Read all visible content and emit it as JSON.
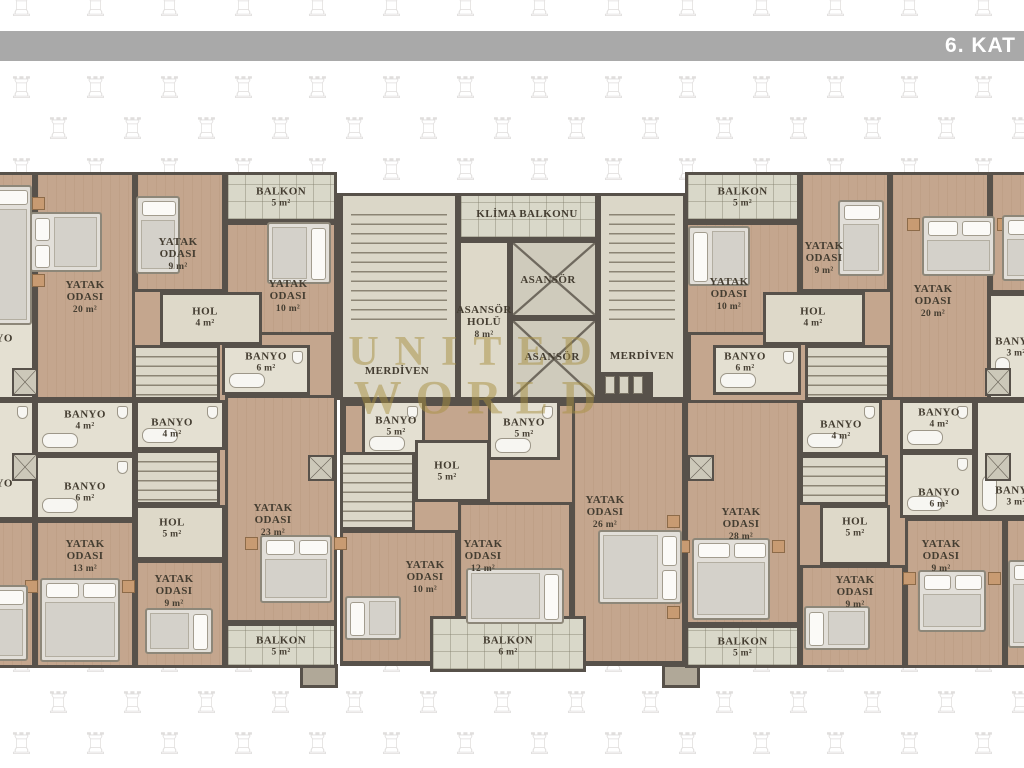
{
  "header": {
    "title": "6. KAT"
  },
  "watermark": {
    "line1": "UNITED",
    "line2": "WORLD"
  },
  "pattern": {
    "glyph": "♖",
    "x0": 8,
    "y0": -8,
    "dx": 74,
    "dy": 41,
    "stagger": 37,
    "cols": 15,
    "rows": 20,
    "size": 30
  },
  "floorplan": {
    "bases": [
      {
        "type": "bedroom",
        "x": -45,
        "y": 172,
        "w": 382,
        "h": 496
      },
      {
        "type": "core",
        "x": 337,
        "y": 193,
        "w": 350,
        "h": 207
      },
      {
        "type": "bedroom",
        "x": 340,
        "y": 400,
        "w": 345,
        "h": 266
      },
      {
        "type": "bedroom",
        "x": 685,
        "y": 172,
        "w": 385,
        "h": 496
      }
    ],
    "rooms": [
      {
        "id": "partial-bedroom-left-top",
        "type": "bedroom",
        "x": -45,
        "y": 172,
        "w": 80,
        "h": 121
      },
      {
        "id": "partial-bath-left-mid",
        "label": "BANYO",
        "area": "m²",
        "type": "bath",
        "x": -45,
        "y": 293,
        "w": 80,
        "h": 107,
        "lx": -8,
        "ly": 344
      },
      {
        "id": "partial-bath-left-bottom",
        "label": "BANYO",
        "area": "m²",
        "type": "bath",
        "x": -45,
        "y": 400,
        "w": 80,
        "h": 120,
        "lx": -8,
        "ly": 489
      },
      {
        "id": "partial-bedroom-left-bottom",
        "type": "bedroom",
        "x": -45,
        "y": 520,
        "w": 80,
        "h": 148
      },
      {
        "id": "yatak-odasi-20-left",
        "label": "YATAK ODASI",
        "area": "20 m²",
        "type": "bedroom",
        "x": 35,
        "y": 172,
        "w": 100,
        "h": 228,
        "lx": 85,
        "ly": 297
      },
      {
        "id": "yatak-odasi-9-left-top",
        "label": "YATAK ODASI",
        "area": "9 m²",
        "type": "bedroom",
        "x": 135,
        "y": 172,
        "w": 90,
        "h": 120,
        "lx": 178,
        "ly": 254
      },
      {
        "id": "balkon-5-left-top",
        "label": "BALKON",
        "area": "5 m²",
        "type": "balcony",
        "x": 225,
        "y": 172,
        "w": 112,
        "h": 50
      },
      {
        "id": "yatak-odasi-10-left-top",
        "label": "YATAK ODASI",
        "area": "10 m²",
        "type": "bedroom",
        "x": 225,
        "y": 222,
        "w": 112,
        "h": 113,
        "lx": 288,
        "ly": 296
      },
      {
        "id": "hol-4-left-top",
        "label": "HOL",
        "area": "4 m²",
        "type": "hall",
        "x": 160,
        "y": 292,
        "w": 102,
        "h": 53,
        "lx": 205,
        "ly": 317
      },
      {
        "id": "stairs-left-top",
        "type": "stair",
        "small": true,
        "x": 133,
        "y": 345,
        "w": 87,
        "h": 55
      },
      {
        "id": "banyo-6-left-top",
        "label": "BANYO",
        "area": "6 m²",
        "type": "bath",
        "x": 222,
        "y": 345,
        "w": 88,
        "h": 50,
        "lx": 266,
        "ly": 362
      },
      {
        "id": "banyo-4-left-a",
        "label": "BANYO",
        "area": "4 m²",
        "type": "bath",
        "x": 35,
        "y": 400,
        "w": 100,
        "h": 55,
        "lx": 85,
        "ly": 420
      },
      {
        "id": "banyo-4-left-b",
        "label": "BANYO",
        "area": "4 m²",
        "type": "bath",
        "x": 135,
        "y": 400,
        "w": 90,
        "h": 50,
        "lx": 172,
        "ly": 428
      },
      {
        "id": "banyo-6-left-bottom",
        "label": "BANYO",
        "area": "6 m²",
        "type": "bath",
        "x": 35,
        "y": 455,
        "w": 100,
        "h": 65,
        "lx": 85,
        "ly": 492
      },
      {
        "id": "stairs-left-bottom",
        "type": "stair",
        "small": true,
        "x": 135,
        "y": 450,
        "w": 85,
        "h": 55
      },
      {
        "id": "hol-5-left-bottom",
        "label": "HOL",
        "area": "5 m²",
        "type": "hall",
        "x": 135,
        "y": 505,
        "w": 90,
        "h": 55,
        "lx": 172,
        "ly": 528
      },
      {
        "id": "yatak-odasi-13-left",
        "label": "YATAK ODASI",
        "area": "13 m²",
        "type": "bedroom",
        "x": 35,
        "y": 520,
        "w": 100,
        "h": 148,
        "lx": 85,
        "ly": 556
      },
      {
        "id": "yatak-odasi-9-left-bottom",
        "label": "YATAK ODASI",
        "area": "9 m²",
        "type": "bedroom",
        "x": 135,
        "y": 560,
        "w": 90,
        "h": 108,
        "lx": 174,
        "ly": 591
      },
      {
        "id": "yatak-odasi-23-left",
        "label": "YATAK ODASI",
        "area": "23 m²",
        "type": "bedroom",
        "x": 225,
        "y": 395,
        "w": 112,
        "h": 228,
        "lx": 273,
        "ly": 520
      },
      {
        "id": "balkon-5-left-bottom",
        "label": "BALKON",
        "area": "5 m²",
        "type": "balcony",
        "x": 225,
        "y": 623,
        "w": 112,
        "h": 45
      },
      {
        "id": "merdiven-left",
        "label": "MERDİVEN",
        "type": "stair",
        "treads": true,
        "x": 340,
        "y": 193,
        "w": 118,
        "h": 207,
        "lx": 397,
        "ly": 371,
        "nowrap": true
      },
      {
        "id": "klima-balkonu",
        "label": "KLİMA BALKONU",
        "type": "balcony",
        "x": 458,
        "y": 193,
        "w": 140,
        "h": 47,
        "lx": 527,
        "ly": 214,
        "nowrap": true
      },
      {
        "id": "asansor-holu",
        "label": "ASANSÖR HOLÜ",
        "area": "8 m²",
        "type": "hall",
        "x": 458,
        "y": 240,
        "w": 52,
        "h": 160,
        "lx": 484,
        "ly": 322
      },
      {
        "id": "asansor-1",
        "label": "ASANSÖR",
        "type": "elevator",
        "x": 510,
        "y": 240,
        "w": 88,
        "h": 78,
        "lx": 548,
        "ly": 280,
        "nowrap": true
      },
      {
        "id": "asansor-2",
        "label": "ASANSÖR",
        "type": "elevator",
        "x": 510,
        "y": 318,
        "w": 88,
        "h": 82,
        "lx": 552,
        "ly": 357,
        "nowrap": true
      },
      {
        "id": "merdiven-right",
        "label": "MERDİVEN",
        "type": "stair",
        "treads": true,
        "x": 598,
        "y": 193,
        "w": 88,
        "h": 207,
        "lx": 642,
        "ly": 356,
        "nowrap": true
      },
      {
        "id": "banyo-5-middle-a",
        "label": "BANYO",
        "area": "5 m²",
        "type": "bath",
        "x": 362,
        "y": 400,
        "w": 63,
        "h": 58,
        "lx": 396,
        "ly": 426
      },
      {
        "id": "banyo-5-middle-b",
        "label": "BANYO",
        "area": "5 m²",
        "type": "bath",
        "x": 488,
        "y": 400,
        "w": 72,
        "h": 60,
        "lx": 524,
        "ly": 428
      },
      {
        "id": "stairs-middle",
        "type": "stair",
        "small": true,
        "x": 340,
        "y": 452,
        "w": 75,
        "h": 78
      },
      {
        "id": "hol-5-middle",
        "label": "HOL",
        "area": "5 m²",
        "type": "hall",
        "x": 415,
        "y": 440,
        "w": 75,
        "h": 62,
        "lx": 447,
        "ly": 471
      },
      {
        "id": "yatak-odasi-10-middle",
        "label": "YATAK ODASI",
        "area": "10 m²",
        "type": "bedroom",
        "x": 340,
        "y": 530,
        "w": 118,
        "h": 134,
        "lx": 425,
        "ly": 577
      },
      {
        "id": "yatak-odasi-12-middle",
        "label": "YATAK ODASI",
        "area": "12 m²",
        "type": "bedroom",
        "x": 458,
        "y": 502,
        "w": 114,
        "h": 162,
        "lx": 483,
        "ly": 556
      },
      {
        "id": "yatak-odasi-26-middle",
        "label": "YATAK ODASI",
        "area": "26 m²",
        "type": "bedroom",
        "x": 572,
        "y": 400,
        "w": 113,
        "h": 264,
        "lx": 605,
        "ly": 512
      },
      {
        "id": "balkon-6-middle",
        "label": "BALKON",
        "area": "6 m²",
        "type": "balcony",
        "x": 430,
        "y": 616,
        "w": 156,
        "h": 56,
        "lx": 508,
        "ly": 646
      },
      {
        "id": "yatak-odasi-28-right",
        "label": "YATAK ODASI",
        "area": "28 m²",
        "type": "bedroom",
        "x": 685,
        "y": 400,
        "w": 115,
        "h": 225,
        "lx": 741,
        "ly": 524
      },
      {
        "id": "banyo-4-right-a",
        "label": "BANYO",
        "area": "4 m²",
        "type": "bath",
        "x": 800,
        "y": 400,
        "w": 82,
        "h": 55,
        "lx": 841,
        "ly": 430
      },
      {
        "id": "banyo-4-right-b",
        "label": "BANYO",
        "area": "4 m²",
        "type": "bath",
        "x": 900,
        "y": 400,
        "w": 75,
        "h": 52,
        "lx": 939,
        "ly": 418
      },
      {
        "id": "stairs-right-bottom",
        "type": "stair",
        "small": true,
        "x": 800,
        "y": 455,
        "w": 88,
        "h": 50
      },
      {
        "id": "hol-5-right",
        "label": "HOL",
        "area": "5 m²",
        "type": "hall",
        "x": 820,
        "y": 505,
        "w": 70,
        "h": 60,
        "lx": 855,
        "ly": 527
      },
      {
        "id": "banyo-6-right-bottom",
        "label": "BANYO",
        "area": "6 m²",
        "type": "bath",
        "x": 900,
        "y": 452,
        "w": 75,
        "h": 66,
        "lx": 939,
        "ly": 498
      },
      {
        "id": "yatak-odasi-9-right-bottom-a",
        "label": "YATAK ODASI",
        "area": "9 m²",
        "type": "bedroom",
        "x": 800,
        "y": 565,
        "w": 105,
        "h": 103,
        "lx": 855,
        "ly": 592
      },
      {
        "id": "yatak-odasi-9-right-bottom-b",
        "label": "YATAK ODASI",
        "area": "9 m²",
        "type": "bedroom",
        "x": 905,
        "y": 518,
        "w": 100,
        "h": 150,
        "lx": 941,
        "ly": 556
      },
      {
        "id": "balkon-5-right-bottom",
        "label": "BALKON",
        "area": "5 m²",
        "type": "balcony",
        "x": 685,
        "y": 625,
        "w": 115,
        "h": 43
      },
      {
        "id": "partial-bath-right-mid",
        "label": "BANYO",
        "area": "3 m²",
        "type": "bath",
        "x": 988,
        "y": 293,
        "w": 82,
        "h": 107,
        "lx": 1016,
        "ly": 347
      },
      {
        "id": "partial-bath-right-bottom",
        "label": "BANYO",
        "area": "3 m²",
        "type": "bath",
        "x": 975,
        "y": 400,
        "w": 95,
        "h": 118,
        "lx": 1016,
        "ly": 496
      },
      {
        "id": "partial-bedroom-right-bottom",
        "type": "bedroom",
        "x": 1005,
        "y": 518,
        "w": 65,
        "h": 150
      },
      {
        "id": "balkon-5-right-top",
        "label": "BALKON",
        "area": "5 m²",
        "type": "balcony",
        "x": 685,
        "y": 172,
        "w": 115,
        "h": 50
      },
      {
        "id": "yatak-odasi-10-right-top",
        "label": "YATAK ODASI",
        "area": "10 m²",
        "type": "bedroom",
        "x": 685,
        "y": 222,
        "w": 115,
        "h": 113,
        "lx": 729,
        "ly": 294
      },
      {
        "id": "yatak-odasi-9-right-top",
        "label": "YATAK ODASI",
        "area": "9 m²",
        "type": "bedroom",
        "x": 800,
        "y": 172,
        "w": 90,
        "h": 120,
        "lx": 824,
        "ly": 258
      },
      {
        "id": "hol-4-right-top",
        "label": "HOL",
        "area": "4 m²",
        "type": "hall",
        "x": 763,
        "y": 292,
        "w": 102,
        "h": 53,
        "lx": 813,
        "ly": 317
      },
      {
        "id": "yatak-odasi-20-right",
        "label": "YATAK ODASI",
        "area": "20 m²",
        "type": "bedroom",
        "x": 890,
        "y": 172,
        "w": 100,
        "h": 228,
        "lx": 933,
        "ly": 301
      },
      {
        "id": "banyo-6-right-top",
        "label": "BANYO",
        "area": "6 m²",
        "type": "bath",
        "x": 713,
        "y": 345,
        "w": 88,
        "h": 50,
        "lx": 745,
        "ly": 362
      },
      {
        "id": "stairs-right-top",
        "type": "stair",
        "small": true,
        "x": 805,
        "y": 345,
        "w": 85,
        "h": 55
      },
      {
        "id": "partial-bedroom-right-top",
        "type": "bedroom",
        "x": 990,
        "y": 172,
        "w": 80,
        "h": 121
      }
    ],
    "shafts": [
      {
        "x": 12,
        "y": 368,
        "w": 26,
        "h": 28
      },
      {
        "x": 12,
        "y": 453,
        "w": 26,
        "h": 28
      },
      {
        "x": 308,
        "y": 455,
        "w": 26,
        "h": 26
      },
      {
        "x": 985,
        "y": 368,
        "w": 26,
        "h": 28
      },
      {
        "x": 985,
        "y": 453,
        "w": 26,
        "h": 28
      },
      {
        "x": 688,
        "y": 455,
        "w": 26,
        "h": 26
      }
    ],
    "ducts": [
      {
        "x": 595,
        "y": 372,
        "w": 58,
        "h": 26
      }
    ],
    "stubs": [
      {
        "x": 300,
        "y": 664,
        "w": 38,
        "h": 24
      },
      {
        "x": 662,
        "y": 664,
        "w": 38,
        "h": 24
      }
    ],
    "beds": [
      {
        "x": -12,
        "y": 185,
        "w": 44,
        "h": 140,
        "pillow": "top"
      },
      {
        "x": 30,
        "y": 212,
        "w": 72,
        "h": 60,
        "pillow": "left",
        "double": true
      },
      {
        "x": 136,
        "y": 196,
        "w": 44,
        "h": 78,
        "pillow": "top"
      },
      {
        "x": 267,
        "y": 222,
        "w": 64,
        "h": 62,
        "pillow": "right"
      },
      {
        "x": 40,
        "y": 578,
        "w": 80,
        "h": 84,
        "pillow": "top",
        "double": true
      },
      {
        "x": 145,
        "y": 608,
        "w": 68,
        "h": 46,
        "pillow": "right"
      },
      {
        "x": 260,
        "y": 535,
        "w": 72,
        "h": 68,
        "pillow": "top",
        "double": true
      },
      {
        "x": -18,
        "y": 585,
        "w": 46,
        "h": 76,
        "pillow": "top"
      },
      {
        "x": 466,
        "y": 568,
        "w": 98,
        "h": 56,
        "pillow": "right"
      },
      {
        "x": 598,
        "y": 530,
        "w": 84,
        "h": 74,
        "pillow": "right",
        "double": true
      },
      {
        "x": 692,
        "y": 538,
        "w": 78,
        "h": 82,
        "pillow": "top",
        "double": true
      },
      {
        "x": 804,
        "y": 606,
        "w": 66,
        "h": 44,
        "pillow": "left"
      },
      {
        "x": 918,
        "y": 570,
        "w": 68,
        "h": 62,
        "pillow": "top",
        "double": true
      },
      {
        "x": 1008,
        "y": 560,
        "w": 40,
        "h": 88,
        "pillow": "top"
      },
      {
        "x": 688,
        "y": 226,
        "w": 62,
        "h": 60,
        "pillow": "left"
      },
      {
        "x": 838,
        "y": 200,
        "w": 46,
        "h": 76,
        "pillow": "top"
      },
      {
        "x": 922,
        "y": 216,
        "w": 73,
        "h": 60,
        "pillow": "top",
        "double": true
      },
      {
        "x": 1002,
        "y": 215,
        "w": 33,
        "h": 66,
        "pillow": "top"
      },
      {
        "x": 345,
        "y": 596,
        "w": 56,
        "h": 44,
        "pillow": "left"
      }
    ]
  }
}
